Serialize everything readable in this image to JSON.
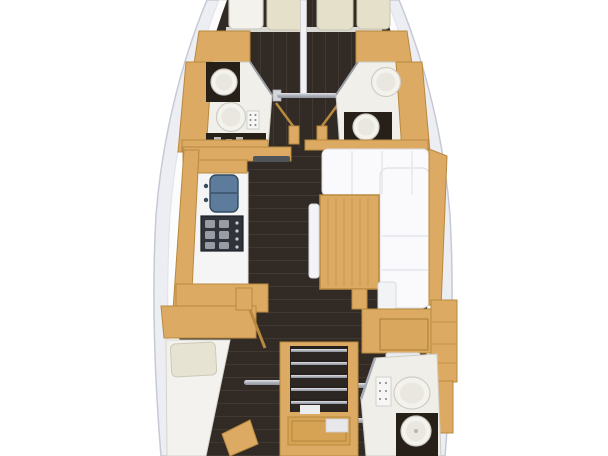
{
  "meta": {
    "kind": "yacht-interior-floor-plan",
    "orientation": "bow-at-top",
    "text_content": []
  },
  "palette": {
    "bg": "#ffffff",
    "hullBand": "#eceef3",
    "hullLine": "#c6cad3",
    "deck": "#fcfcfd",
    "floor": "#322b25",
    "plank": "#4a423a",
    "wood": "#dcaa62",
    "woodEdge": "#b8893f",
    "woodPanel": "#d6a254",
    "white": "#fafafc",
    "whiteEdge": "#d9dbe1",
    "seam": "#e4e6ec",
    "pillow": "#e4e0c9",
    "pillowEdge": "#c8c4ad",
    "counterDark": "#262019",
    "porcelain": "#f3f2ed",
    "porcelainEdge": "#cfccc3",
    "porcelainInner": "#e9e7e0",
    "sinkBlue": "#5d7b9a",
    "sinkBlueEdge": "#324a60",
    "stove": "#30343a",
    "grate": "#aab0b8",
    "tvBar": "#4f545b",
    "panelDot": "#84847e",
    "bedWhite": "#f3f2ee",
    "bedEdge": "#d6d4cd"
  },
  "rooms": [
    {
      "name": "forward-port-cabin",
      "features": [
        "v-berth",
        "pillows"
      ]
    },
    {
      "name": "forward-starboard-cabin",
      "features": [
        "v-berth",
        "pillows"
      ]
    },
    {
      "name": "forward-port-head",
      "features": [
        "sink",
        "toilet",
        "control-panel"
      ]
    },
    {
      "name": "forward-starboard-head",
      "features": [
        "toilet",
        "sink"
      ]
    },
    {
      "name": "galley",
      "features": [
        "double-sink",
        "stove",
        "counter"
      ]
    },
    {
      "name": "salon",
      "features": [
        "l-shaped-sofa",
        "table",
        "bench",
        "sideboard"
      ]
    },
    {
      "name": "nav-station",
      "features": [
        "chart-desk",
        "seat",
        "lockers"
      ]
    },
    {
      "name": "aft-port-cabin",
      "features": [
        "berth",
        "pillow",
        "shelf"
      ]
    },
    {
      "name": "companionway",
      "features": [
        "stairs",
        "engine-hatch",
        "grab-rails"
      ]
    },
    {
      "name": "aft-starboard-head",
      "features": [
        "toilet",
        "sink",
        "control-panel"
      ]
    }
  ]
}
